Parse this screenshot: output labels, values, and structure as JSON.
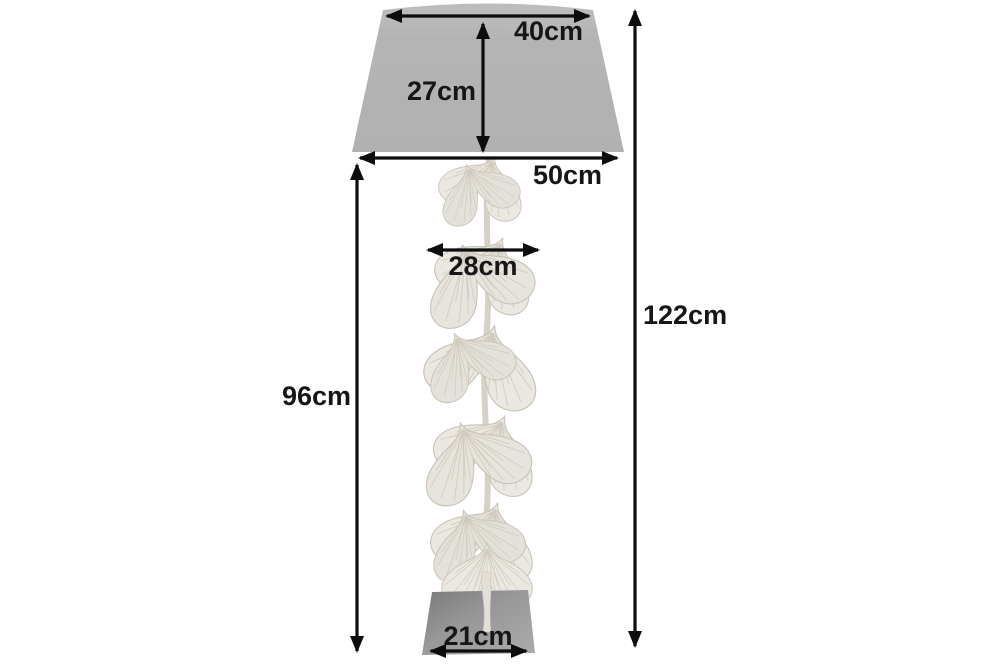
{
  "diagram": {
    "type": "product-dimensions",
    "product": "ginkgo-leaf-floor-lamp",
    "unit": "cm",
    "dimensions": {
      "shade_top_width": "40cm",
      "shade_height": "27cm",
      "shade_bottom_width": "50cm",
      "leaf_column_width": "28cm",
      "stand_height": "96cm",
      "total_height": "122cm",
      "base_width": "21cm"
    },
    "colors": {
      "shade": "#b4b4b4",
      "leaf_fill": "#ebe8e2",
      "leaf_fill_alt": "#e4e1da",
      "stem": "#ddd8ce",
      "dimension_ink": "#0d0d0d",
      "background": "#ffffff"
    }
  }
}
